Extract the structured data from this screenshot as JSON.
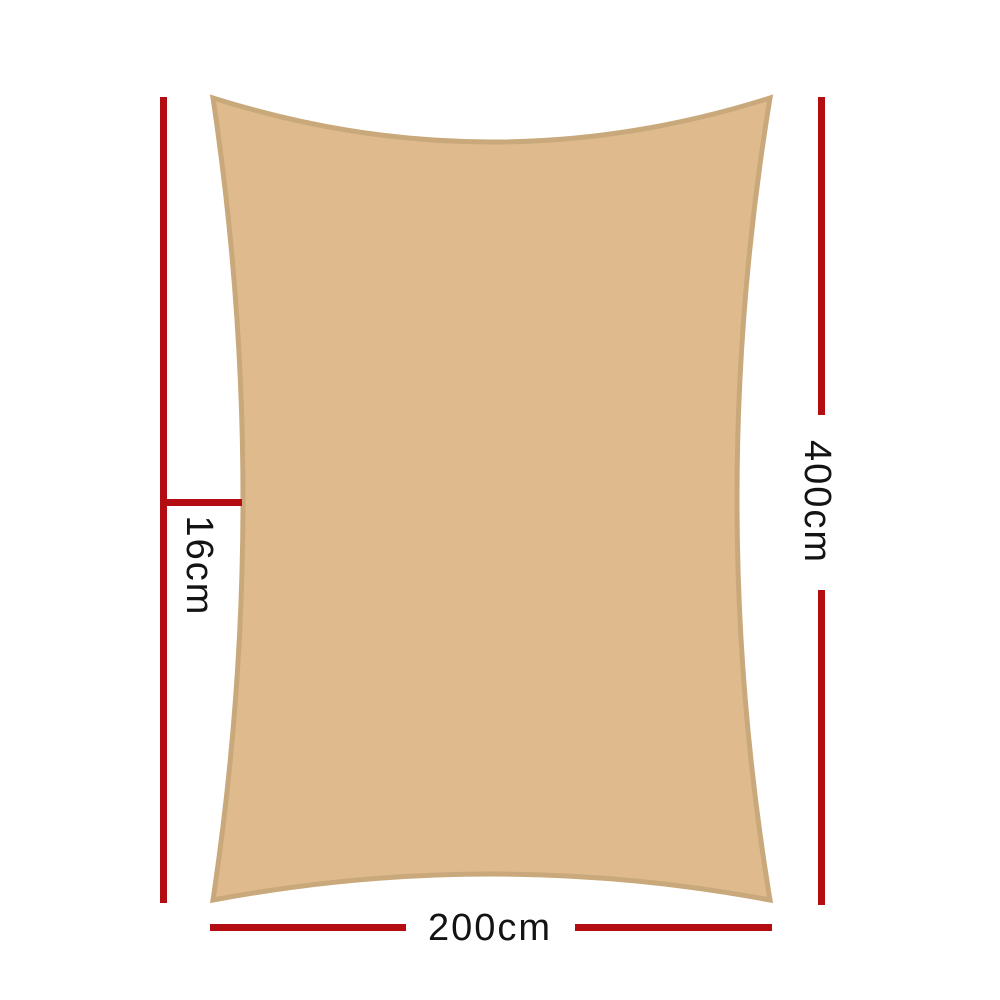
{
  "page": {
    "background": "#ffffff",
    "description": "Shade sail product dimension diagram"
  },
  "colors": {
    "page-background": "#ffffff",
    "dimension-line": "#b30d12",
    "sail-fill": "#dfba8d",
    "sail-border": "#c9a97b",
    "label-text": "#131313"
  },
  "diagram": {
    "shape": "rectangular shade sail with concave edges",
    "dimensions": {
      "height": {
        "label": "400cm"
      },
      "width": {
        "label": "200cm"
      },
      "inset": {
        "label": "16cm"
      }
    }
  }
}
